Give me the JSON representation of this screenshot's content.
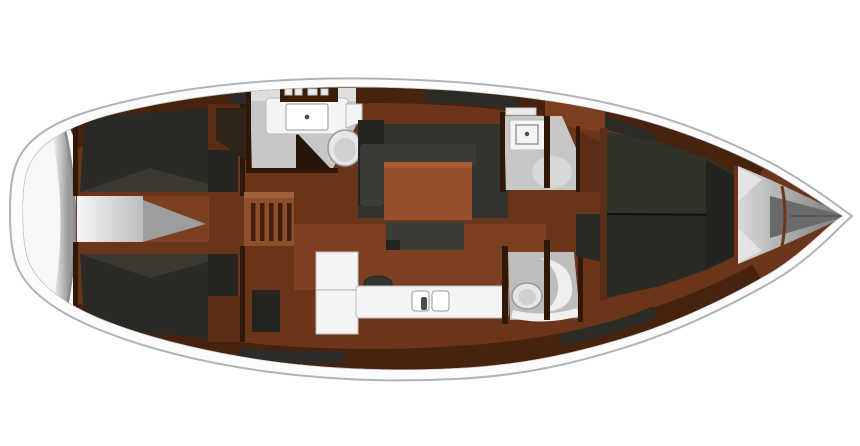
{
  "figure": {
    "kind": "yacht-interior-floor-plan",
    "view": "top-down",
    "orientation": "bow-right-stern-left",
    "visible_text": [],
    "regions": [
      {
        "id": "hull",
        "name": "hull-outline"
      },
      {
        "id": "stern-platform",
        "name": "stern-swim-platform"
      },
      {
        "id": "aft-cabin-top",
        "name": "aft-cabin-berth-starboard"
      },
      {
        "id": "aft-cabin-bottom",
        "name": "aft-cabin-berth-port"
      },
      {
        "id": "stern-walkway",
        "name": "stern-walkway"
      },
      {
        "id": "companionway",
        "name": "companionway-stairs"
      },
      {
        "id": "head-aft-top",
        "name": "aft-head-with-sink-and-toilet"
      },
      {
        "id": "wardrobe",
        "name": "wardrobe-locker"
      },
      {
        "id": "salon",
        "name": "salon-u-sofa-and-table"
      },
      {
        "id": "galley",
        "name": "galley-counter-fridge-sinks"
      },
      {
        "id": "head-fwd-top",
        "name": "forward-head-sink"
      },
      {
        "id": "head-bottom",
        "name": "shower-room-toilet"
      },
      {
        "id": "forward-cabin",
        "name": "forward-cabin-v-berth"
      },
      {
        "id": "anchor-locker",
        "name": "bow-anchor-locker"
      }
    ]
  },
  "colors": {
    "bg": "#ffffff",
    "hull-fill": "#fcfcfc",
    "hull-outline": "#b3b3b3",
    "hull-inner-line": "#c8c8c8",
    "deck-white": "#f7f7f7",
    "transom-light": "#ededed",
    "transom-dark": "#9a9a9a",
    "wood-base": "#6b3519",
    "wood-light": "#7c3f20",
    "wood-mid": "#8f4f2a",
    "wood-trim": "#5c2d16",
    "lining": "#47220f",
    "charcoal": "#2d2b25",
    "charcoal-light": "#3a382f",
    "charcoal-block": "#31332c",
    "berth": "#2a2a24",
    "berth-sheen": "#32322b",
    "wall": "#2f1709",
    "dark-box": "#262420",
    "gray-room": "#c7c7c7",
    "gray-room-band": "#dedede",
    "gray-room-dark": "#9d9d9d",
    "white-fixture": "#f4f4f4",
    "fixture-stroke": "#bbbbbb",
    "fixture-stroke-dark": "#9a9a9a",
    "fixture-metal": "#4a4a4a",
    "toilet": "#e6e6e6",
    "toilet-inner": "#d0d0d0",
    "sofa": "#3a3d35",
    "table": "#96512c",
    "table-edge": "#a85f33",
    "stair-box": "#8f4f2a",
    "stair-lip": "#a06038",
    "stair-slat": "#401f0d",
    "dark-wedge": "#2e2517",
    "shadow-tri": "#241509",
    "bow-light": "#d9d9d9",
    "bow-dark": "#787878",
    "bow-cone": "#6a6a6a",
    "bow-divider": "#6f3417",
    "cabinet-dark": "#3a1d07",
    "hatch": "#ebebeb",
    "walk-white": "#f6f6f6",
    "walk-gray": "#bdbdbd"
  }
}
